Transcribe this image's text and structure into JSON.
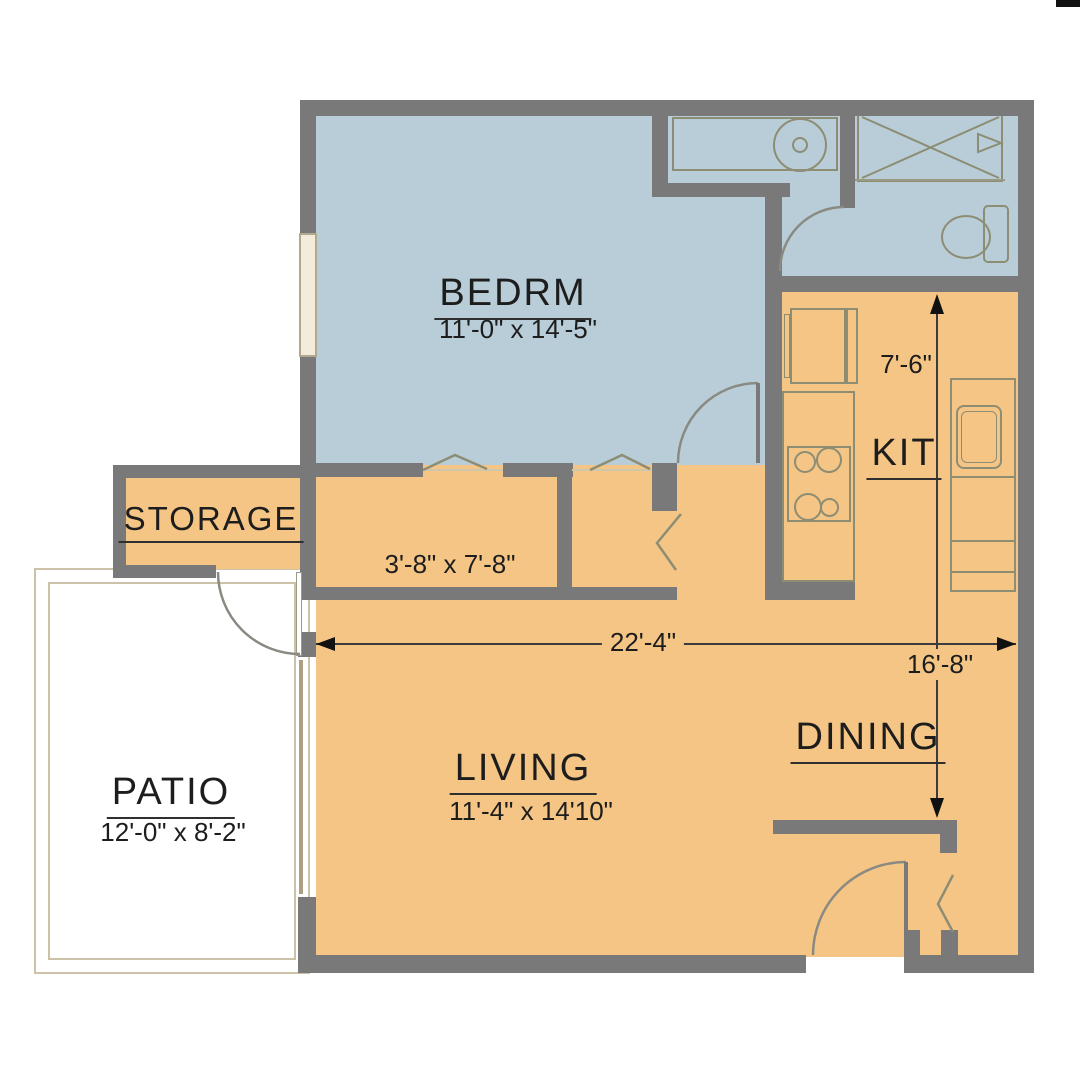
{
  "plan": {
    "title": "One-bedroom apartment floor plan",
    "rooms": {
      "bedroom": {
        "label": "BEDRM",
        "dims": "11'-0\" x 14'-5\""
      },
      "storage": {
        "label": "STORAGE"
      },
      "closet": {
        "dims": "3'-8\" x  7'-8\""
      },
      "kitchen": {
        "label": "KIT"
      },
      "dining": {
        "label": "DINING"
      },
      "living": {
        "label": "LIVING",
        "dims": "11'-4\" x 14'10\""
      },
      "patio": {
        "label": "PATIO",
        "dims": "12'-0\" x  8'-2\""
      }
    },
    "dimensions": {
      "kitchen_depth": "7'-6\"",
      "overall_width": "22'-4\"",
      "dining_depth": "16'-8\""
    },
    "colors": {
      "wall": "#797979",
      "floor_warm": "#f5c585",
      "floor_cool": "#b8cdd8",
      "fixture": "#8d8d74",
      "patio_line": "#cbc2a8",
      "ink": "#1d1d1d",
      "dim": "#3c3c3c"
    }
  }
}
